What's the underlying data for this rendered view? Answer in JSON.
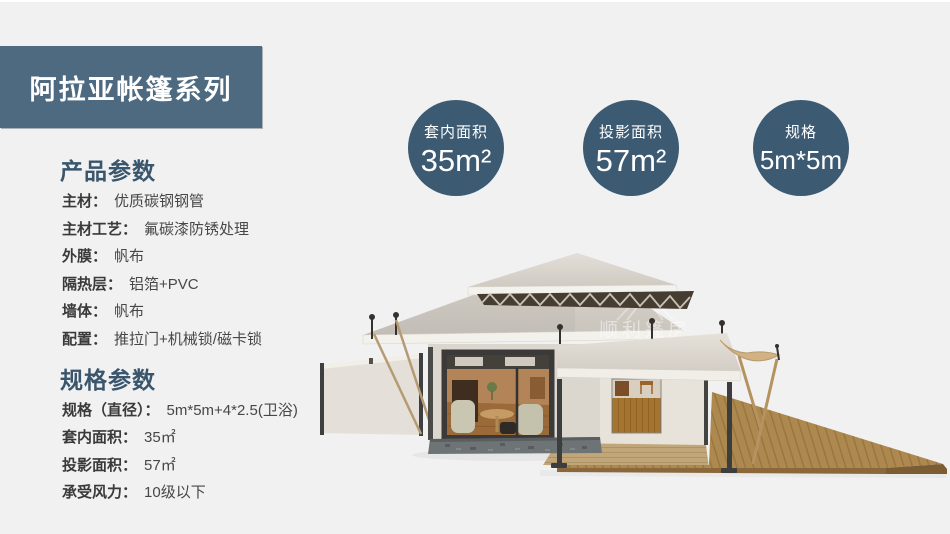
{
  "banner": {
    "title": "阿拉亚帐篷系列"
  },
  "stats": [
    {
      "label": "套内面积",
      "value": "35m²"
    },
    {
      "label": "投影面积",
      "value": "57m²"
    },
    {
      "label": "规格",
      "value": "5m*5m"
    }
  ],
  "sections": [
    {
      "heading": "产品参数",
      "rows": [
        {
          "label": "主材：",
          "value": "优质碳钢钢管"
        },
        {
          "label": "主材工艺：",
          "value": "氟碳漆防锈处理"
        },
        {
          "label": "外膜：",
          "value": "帆布"
        },
        {
          "label": "隔热层：",
          "value": "铝箔+PVC"
        },
        {
          "label": "墙体：",
          "value": "帆布"
        },
        {
          "label": "配置：",
          "value": "推拉门+机械锁/磁卡锁"
        }
      ]
    },
    {
      "heading": "规格参数",
      "rows": [
        {
          "label": "规格（直径）：",
          "value": "5m*5m+4*2.5(卫浴)"
        },
        {
          "label": "套内面积：",
          "value": "35㎡"
        },
        {
          "label": "投影面积：",
          "value": "57㎡"
        },
        {
          "label": "承受风力：",
          "value": "10级以下"
        }
      ]
    }
  ],
  "watermark": {
    "cn": "顺利篷房",
    "en": "WELL TENT"
  },
  "colors": {
    "background": "#f1f1f2",
    "banner": "#4e6a80",
    "accent": "#3c5a72",
    "heading": "#3a566c",
    "roof": "#d5d0c8",
    "deck": "#ad8950"
  }
}
